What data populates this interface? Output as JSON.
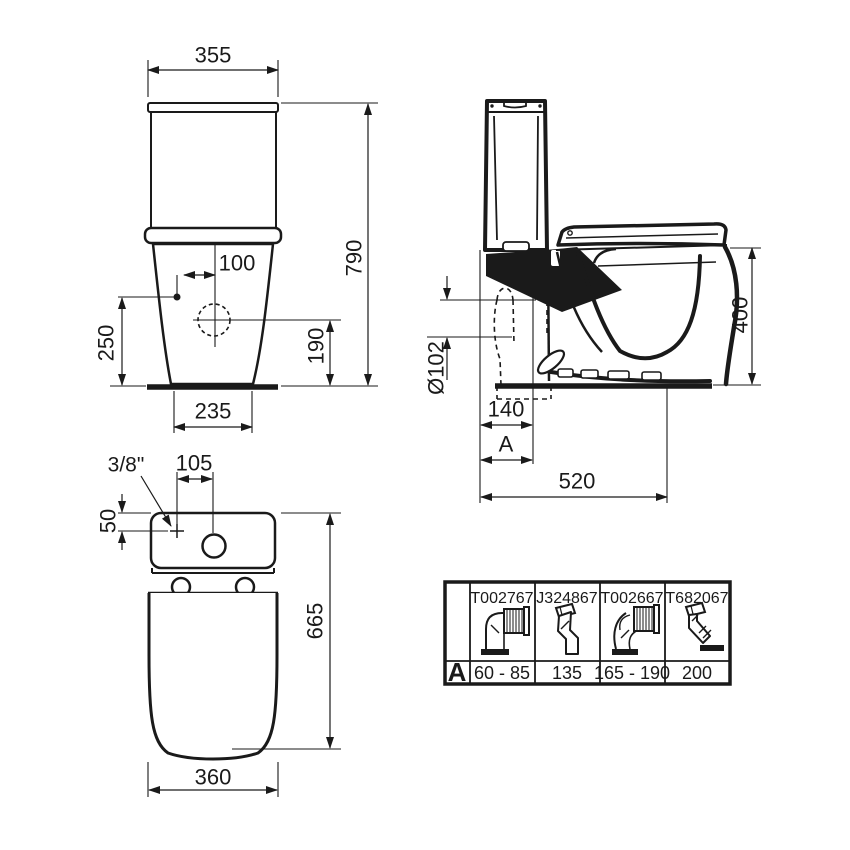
{
  "drawing": {
    "colors": {
      "line": "#1a1a1a",
      "background": "#ffffff"
    },
    "front_view": {
      "top_width": "355",
      "total_height": "790",
      "inlet_to_center": "100",
      "inlet_height": "250",
      "outlet_center_height": "190",
      "base_width": "235"
    },
    "side_view": {
      "outlet_diameter": "Ø102",
      "outlet_to_wall": "140",
      "adapter_dim": "A",
      "total_depth": "520",
      "rim_height": "400"
    },
    "top_view": {
      "water_inlet": "3/8\"",
      "inlet_to_flush": "105",
      "inlet_depth": "50",
      "total_length": "665",
      "bowl_width": "360"
    },
    "adapter_table": {
      "row_label": "A",
      "columns": [
        {
          "code": "T002767",
          "value": "60 - 85",
          "icon": "elbow-corrugated-connector-icon"
        },
        {
          "code": "J324867",
          "value": "135",
          "icon": "offset-connector-icon"
        },
        {
          "code": "T002667",
          "value": "165 - 190",
          "icon": "long-elbow-corrugated-connector-icon"
        },
        {
          "code": "T682067",
          "value": "200",
          "icon": "angled-connector-icon"
        }
      ]
    }
  }
}
